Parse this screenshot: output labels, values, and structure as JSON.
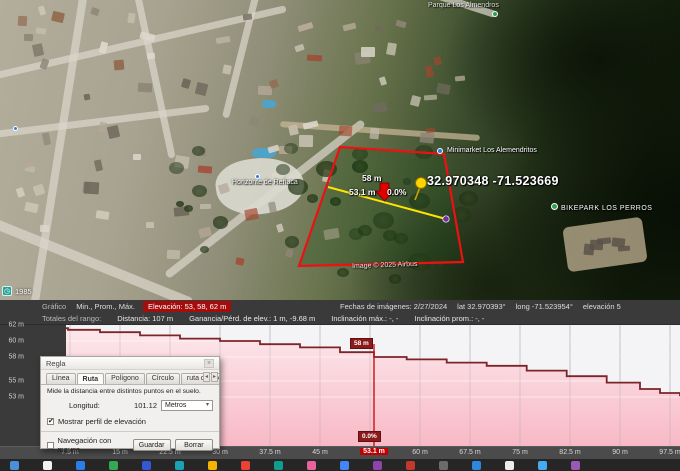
{
  "map": {
    "labels": {
      "coords": "32.970348  -71.523669",
      "elev": "58 m",
      "dist": "53.1 m",
      "slope": "0.0%"
    },
    "pois": {
      "minimarket": "Minimarket Los Alemendritos",
      "bikepark": "BIKEPARK LOS PERROS",
      "horizonte": "Horizonte de Reñaca",
      "parque": "Parque Los Almendros"
    },
    "copyright": "Image © 2025 Airbus",
    "history_year": "1985"
  },
  "status": {
    "fechas": "Fechas de imágenes: 2/27/2024",
    "lat": "lat  32.970393°",
    "long": "long  -71.523954°",
    "elev": "elevación  5"
  },
  "header": {
    "grafico": "Gráfico",
    "minpromax": "Min., Prom., Máx.",
    "elev_chip": "Elevación: 53, 58, 62 m"
  },
  "stats": {
    "totales": "Totales del rango:",
    "distancia": "Distancia: 107 m",
    "ganancia": "Ganancia/Pérd. de elev.: 1 m, -9.68 m",
    "incl_max": "Inclinación máx.: -, -",
    "incl_prom": "Inclinación prom.: -, -"
  },
  "chart_data": {
    "type": "area",
    "title": "Perfil de elevación",
    "xlabel": "distancia (m)",
    "ylabel": "elevación (m)",
    "x_range": [
      0,
      107
    ],
    "y_range": [
      53,
      62
    ],
    "grid": true,
    "x": [
      0,
      7.2,
      12,
      18,
      24,
      30,
      36,
      42,
      48,
      53.1,
      58,
      64,
      70,
      76,
      82,
      88,
      93,
      96,
      99
    ],
    "elevations": [
      61.6,
      61.4,
      61.1,
      60.7,
      60.3,
      60.0,
      59.6,
      59.2,
      58.6,
      58.0,
      57.7,
      57.3,
      56.9,
      56.3,
      55.6,
      54.8,
      54.0,
      53.5,
      53.1
    ],
    "y_ticks": [
      {
        "label": "62 m",
        "elev": 62
      },
      {
        "label": "60 m",
        "elev": 60
      },
      {
        "label": "58 m",
        "elev": 58
      },
      {
        "label": "55 m",
        "elev": 55
      },
      {
        "label": "53 m",
        "elev": 53
      }
    ],
    "x_ticks": [
      {
        "label": "7.5 m",
        "d": 7.5,
        "hot": false
      },
      {
        "label": "15 m",
        "d": 15,
        "hot": false
      },
      {
        "label": "22.5 m",
        "d": 22.5,
        "hot": false
      },
      {
        "label": "30 m",
        "d": 30,
        "hot": false
      },
      {
        "label": "37.5 m",
        "d": 37.5,
        "hot": false
      },
      {
        "label": "45 m",
        "d": 45,
        "hot": false
      },
      {
        "label": "53.1 m",
        "d": 53.1,
        "hot": true
      },
      {
        "label": "60 m",
        "d": 60,
        "hot": false
      },
      {
        "label": "67.5 m",
        "d": 67.5,
        "hot": false
      },
      {
        "label": "75 m",
        "d": 75,
        "hot": false
      },
      {
        "label": "82.5 m",
        "d": 82.5,
        "hot": false
      },
      {
        "label": "90 m",
        "d": 90,
        "hot": false
      },
      {
        "label": "97.5 m",
        "d": 97.5,
        "hot": false
      }
    ],
    "marker": {
      "d": 53.1,
      "elev_label": "58 m",
      "slope_label": "0.0%",
      "dist_label": "53.1 m"
    },
    "colors": {
      "line": "#7d2429",
      "fill_top": "#fce8ec",
      "fill_bottom": "#f8b9c6",
      "marker": "#cc1111"
    }
  },
  "dialog": {
    "title": "Regla",
    "tabs": [
      {
        "label": "Línea",
        "active": false
      },
      {
        "label": "Ruta",
        "active": true
      },
      {
        "label": "Polígono",
        "active": false
      },
      {
        "label": "Círculo",
        "active": false
      },
      {
        "label": "ruta de acceso en 3D",
        "active": false
      }
    ],
    "description": "Mide la distancia entre distintos puntos en el suelo.",
    "length_label": "Longitud:",
    "length_value": "101.12",
    "unit_value": "Metros",
    "show_profile_label": "Mostrar perfil de elevación",
    "show_profile_checked": true,
    "mouse_nav_label": "Navegación con mouse",
    "mouse_nav_checked": false,
    "save_label": "Guardar",
    "clear_label": "Borrar"
  },
  "taskbar": {
    "icon_colors": [
      "#4a90d9",
      "#f2f2f2",
      "#2b7de9",
      "#34a853",
      "#3557d4",
      "#18a3b5",
      "#f4b400",
      "#ea4335",
      "#0f9d8e",
      "#e8639c",
      "#4285f4",
      "#8e44ad",
      "#c0392b",
      "#6b6b6b",
      "#2e86de",
      "#ececec",
      "#45aaf2",
      "#9b59b6"
    ]
  }
}
